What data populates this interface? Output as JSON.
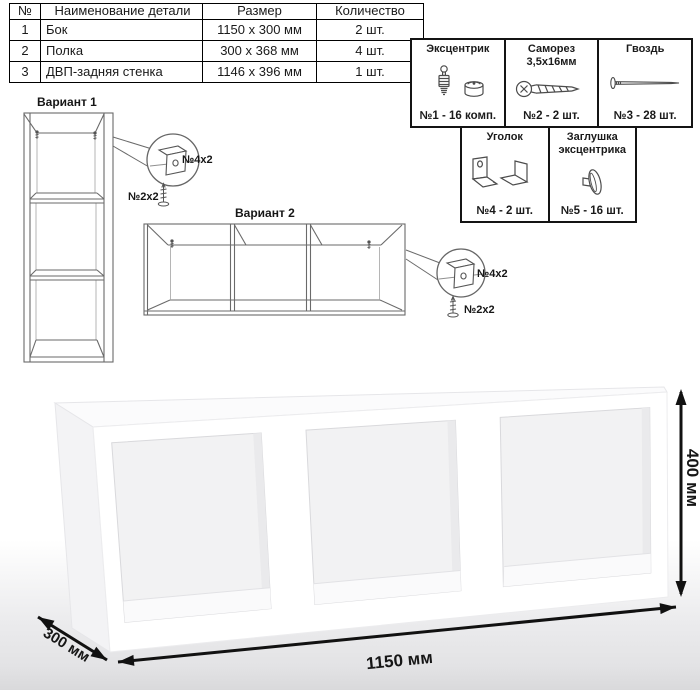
{
  "parts_table": {
    "headers": {
      "num": "№",
      "name": "Наименование детали",
      "size": "Размер",
      "qty": "Количество"
    },
    "rows": [
      {
        "num": "1",
        "name": "Бок",
        "size": "1150 х 300 мм",
        "qty": "2 шт."
      },
      {
        "num": "2",
        "name": "Полка",
        "size": "300 х 368 мм",
        "qty": "4 шт."
      },
      {
        "num": "3",
        "name": "ДВП-задняя стенка",
        "size": "1146 х 396 мм",
        "qty": "1 шт."
      }
    ]
  },
  "hardware": {
    "items": [
      {
        "name": "Эксцентрик",
        "name2": "",
        "count": "№1 - 16 комп.",
        "icon": "cam-fitting-icon"
      },
      {
        "name": "Саморез",
        "name2": "3,5х16мм",
        "count": "№2 - 2 шт.",
        "icon": "screw-icon"
      },
      {
        "name": "Гвоздь",
        "name2": "",
        "count": "№3 - 28 шт.",
        "icon": "nail-icon"
      },
      {
        "name": "Уголок",
        "name2": "",
        "count": "№4 - 2 шт.",
        "icon": "corner-bracket-icon"
      },
      {
        "name": "Заглушка",
        "name2": "эксцентрика",
        "count": "№5 - 16 шт.",
        "icon": "cam-cap-icon"
      }
    ]
  },
  "variants": {
    "v1": {
      "title": "Вариант 1",
      "bracket_label": "№4х2",
      "screw_label": "№2х2"
    },
    "v2": {
      "title": "Вариант 2",
      "bracket_label": "№4х2",
      "screw_label": "№2х2"
    }
  },
  "dimensions": {
    "width": "1150 мм",
    "depth": "300 мм",
    "height": "400 мм"
  },
  "colors": {
    "line": "#6a6a6a",
    "dim": "#111111",
    "table_border": "#000000",
    "interior": "#f2f2f3"
  }
}
